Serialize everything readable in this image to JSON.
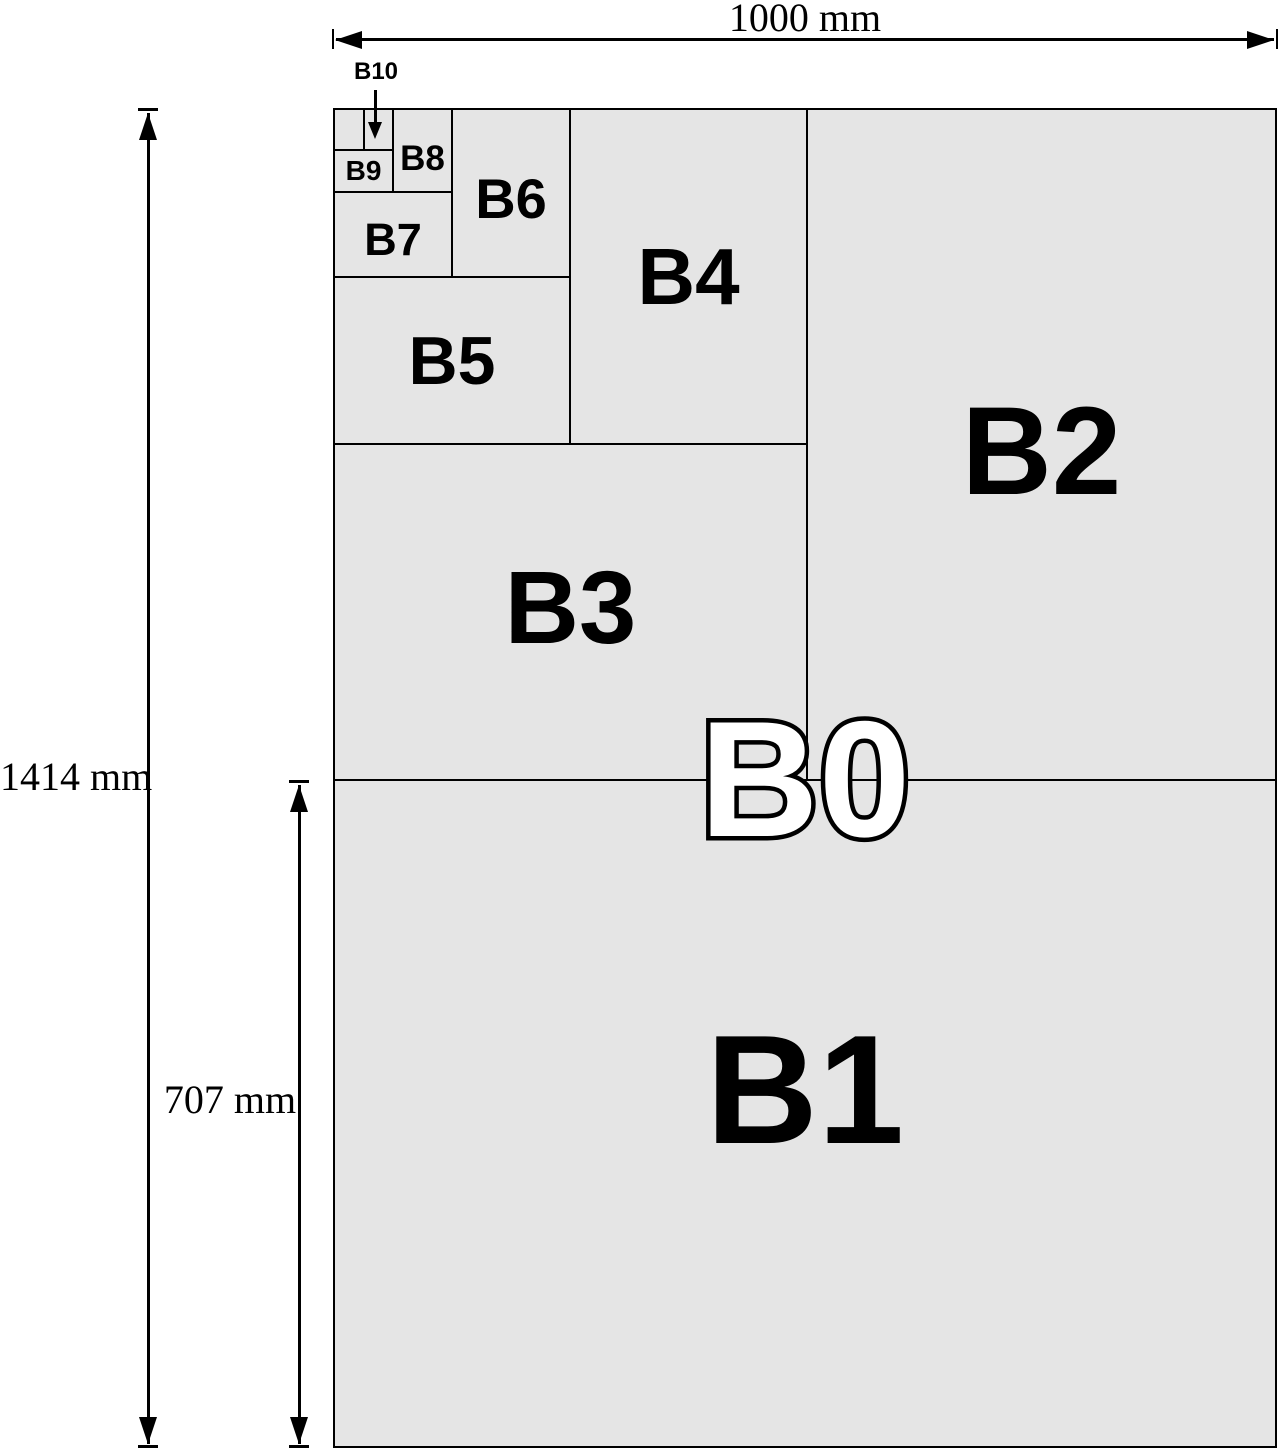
{
  "colors": {
    "background": "#ffffff",
    "sheet_fill": "#e5e5e5",
    "line": "#000000",
    "b0_label_fill": "#ffffff",
    "b0_label_outline": "#000000"
  },
  "dimension_labels": {
    "width": "1000 mm",
    "height": "1414 mm",
    "half_height": "707 mm"
  },
  "labels": {
    "b0": "B0",
    "b1": "B1",
    "b2": "B2",
    "b3": "B3",
    "b4": "B4",
    "b5": "B5",
    "b6": "B6",
    "b7": "B7",
    "b8": "B8",
    "b9": "B9",
    "b10": "B10"
  }
}
